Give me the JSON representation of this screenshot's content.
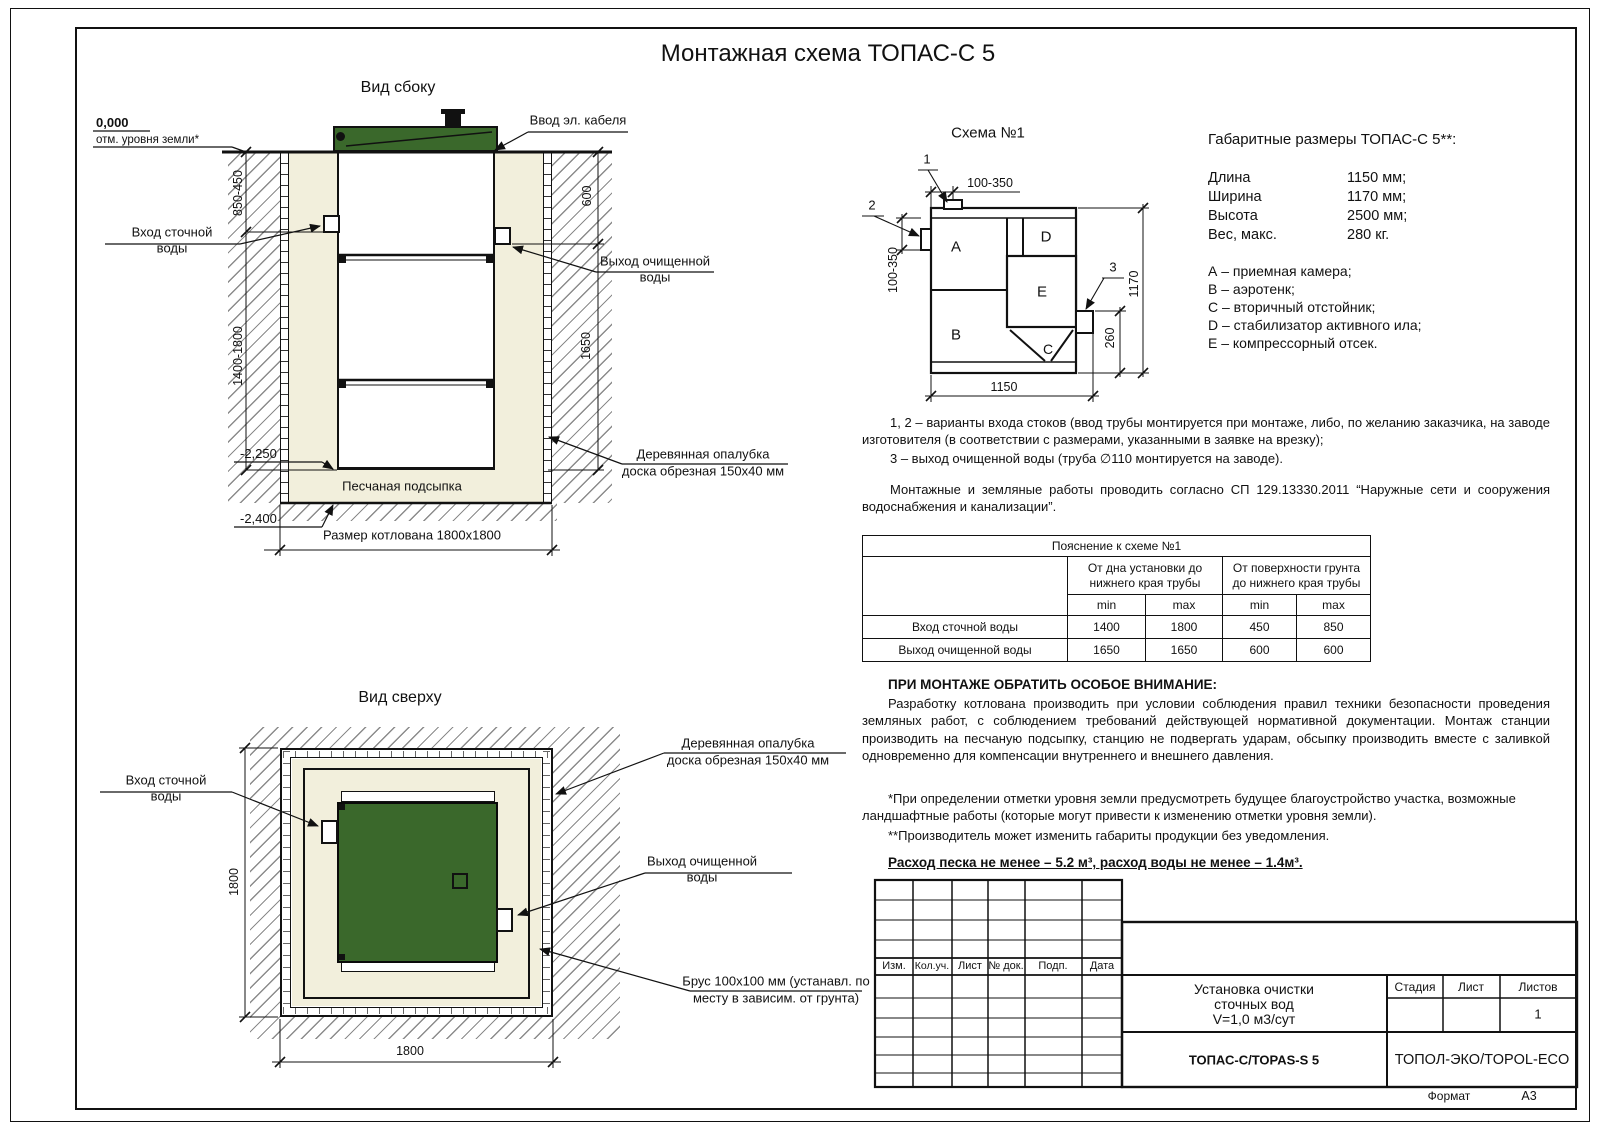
{
  "sheet": {
    "title": "Монтажная схема ТОПАС-С 5",
    "format_label": "Формат",
    "format_value": "А3"
  },
  "colors": {
    "lid_green": "#3a682b",
    "sand": "#f2efdc",
    "line": "#111111"
  },
  "side_view": {
    "caption": "Вид сбоку",
    "zero_mark": "0,000",
    "zero_note": "отм. уровня земли*",
    "cable": "Ввод эл. кабеля",
    "inlet_l1": "Вход сточной",
    "inlet_l2": "воды",
    "outlet_l1": "Выход очищенной",
    "outlet_l2": "воды",
    "dim_inlet_depth": "850-450",
    "dim_outlet_depth": "600",
    "dim_inlet_range": "1400-1800",
    "dim_outlet_range": "1650",
    "mark_2250": "-2,250",
    "mark_2400": "-2,400",
    "sand_label": "Песчаная подсыпка",
    "pit_label": "Размер котлована 1800х1800",
    "formwork_l1": "Деревянная опалубка",
    "formwork_l2": "доска обрезная 150х40 мм"
  },
  "top_view": {
    "caption": "Вид сверху",
    "inlet_l1": "Вход сточной",
    "inlet_l2": "воды",
    "outlet_l1": "Выход очищенной",
    "outlet_l2": "воды",
    "formwork_l1": "Деревянная опалубка",
    "formwork_l2": "доска обрезная 150х40 мм",
    "beam_l1": "Брус 100х100 мм (устанавл. по",
    "beam_l2": "месту в зависим. от грунта)",
    "dim_v": "1800",
    "dim_h": "1800"
  },
  "schema": {
    "caption": "Схема №1",
    "callout1": "1",
    "callout2": "2",
    "callout3": "3",
    "comp_a": "A",
    "comp_b": "B",
    "comp_c": "C",
    "comp_d": "D",
    "comp_e": "E",
    "dim_top": "100-350",
    "dim_left": "100-350",
    "dim_width": "1150",
    "dim_height": "1170",
    "dim_outlet": "260"
  },
  "specs": {
    "title": "Габаритные размеры ТОПАС-С 5**:",
    "rows": [
      {
        "k": "Длина",
        "v": "1150 мм;"
      },
      {
        "k": "Ширина",
        "v": "1170 мм;"
      },
      {
        "k": "Высота",
        "v": "2500 мм;"
      },
      {
        "k": "Вес, макс.",
        "v": "280 кг."
      }
    ],
    "legend": [
      "А – приемная камера;",
      "В – аэротенк;",
      "С – вторичный отстойник;",
      "D – стабилизатор активного ила;",
      "Е – компрессорный отсек."
    ]
  },
  "notes": {
    "p1a": "1, 2 – варианты входа  стоков (ввод трубы монтируется при монтаже, либо, по желанию заказчика, на заводе изготовителя (в соответствии с размерами, указанными в заявке на врезку);",
    "p1b": "3 – выход очищенной воды (труба ∅110 монтируется на заводе).",
    "p2": "Монтажные и земляные работы проводить согласно СП 129.13330.2011 “Наружные сети и сооружения водоснабжения и канализации”."
  },
  "table": {
    "title": "Пояснение к схеме №1",
    "g1": "От дна установки до нижнего края трубы",
    "g2": "От поверхности грунта до нижнего края трубы",
    "min": "min",
    "max": "max",
    "rows": [
      {
        "label": "Вход сточной воды",
        "v": [
          "1400",
          "1800",
          "450",
          "850"
        ]
      },
      {
        "label": "Выход очищенной воды",
        "v": [
          "1650",
          "1650",
          "600",
          "600"
        ]
      }
    ]
  },
  "attention": {
    "title": "ПРИ МОНТАЖЕ ОБРАТИТЬ ОСОБОЕ ВНИМАНИЕ:",
    "body": "Разработку котлована производить при условии соблюдения правил техники безопасности проведения земляных работ, с соблюдением требований действующей нормативной документации. Монтаж станции производить на песчаную подсыпку, станцию не подвергать ударам, обсыпку производить вместе с заливкой одновременно для компенсации внутреннего и внешнего давления.",
    "fn1": "*При определении отметки уровня земли предусмотреть будущее благоустройство участка, возможные ландшафтные работы (которые могут привести к изменению отметки уровня земли).",
    "fn2": "**Производитель может изменить габариты продукции без уведомления.",
    "consumption": "Расход песка не менее – 5.2 м³, расход воды не менее – 1.4м³."
  },
  "stamp": {
    "cols": [
      "Изм.",
      "Кол.уч.",
      "Лист",
      "№ док.",
      "Подп.",
      "Дата"
    ],
    "doc1": "Установка очистки",
    "doc2": "сточных вод",
    "doc3": "V=1,0 м3/сут",
    "model": "ТОПАС-С/TOPAS-S 5",
    "company": "ТОПОЛ-ЭКО/TOPOL-ECO",
    "stage": "Стадия",
    "sheet": "Лист",
    "sheets": "Листов",
    "sheets_val": "1"
  }
}
